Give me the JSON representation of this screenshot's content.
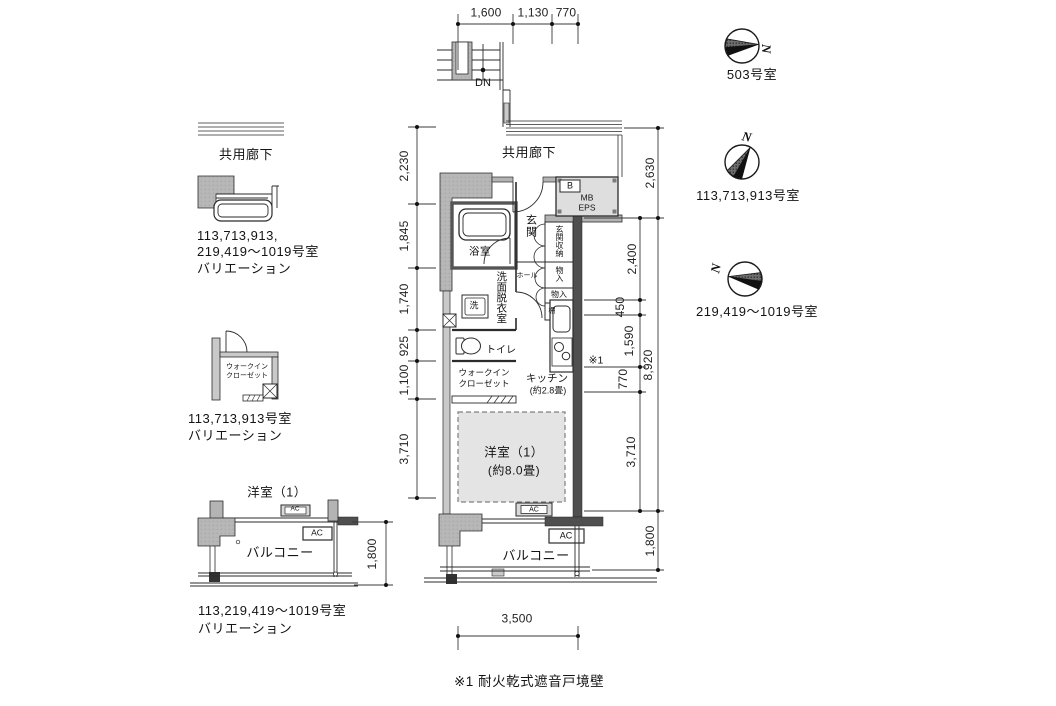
{
  "note": "※1 耐火乾式遮音戸境壁",
  "dims": {
    "top": [
      "1,600",
      "1,130",
      "770"
    ],
    "left": [
      "2,230",
      "1,845",
      "1,740",
      "925",
      "1,100",
      "3,710"
    ],
    "right_inner": [
      "2,400",
      "450",
      "1,590",
      "770",
      "3,710"
    ],
    "right_outer": [
      "2,630",
      "8,920",
      "1,800"
    ],
    "bottom": "3,500"
  },
  "plan": {
    "corridor": "共用廊下",
    "down": "DN",
    "b_box": "B",
    "mb": "MB",
    "eps": "EPS",
    "bath": "浴室",
    "entrance": "玄関",
    "entrance_storage": "玄関収納",
    "storage_a": "物入",
    "storage_b": "物入",
    "shelf": "棚",
    "hall": "ホール",
    "washroom": "洗面脱衣室",
    "washer": "洗",
    "toilet": "トイレ",
    "wic1": "ウォークイン",
    "wic2": "クローゼット",
    "kitchen1": "キッチン",
    "kitchen2": "(約2.8畳)",
    "room1": "洋室（1）",
    "room2": "(約8.0畳)",
    "ac_window": "AC",
    "ac_balcony": "AC",
    "balcony": "バルコニー",
    "ref1": "※1"
  },
  "variations": {
    "top": {
      "corridor": "共用廊下",
      "caption1": "113,713,913,",
      "caption2": "219,419～1019号室",
      "caption3": "バリエーション"
    },
    "middle": {
      "wic1": "ウォークイン",
      "wic2": "クローゼット",
      "caption1": "113,713,913号室",
      "caption2": "バリエーション"
    },
    "bottom": {
      "room": "洋室（1）",
      "ac1": "AC",
      "ac2": "AC",
      "balcony": "バルコニー",
      "dim": "1,800",
      "caption1": "113,219,419～1019号室",
      "caption2": "バリエーション"
    }
  },
  "compasses": [
    {
      "north": "N",
      "label": "503号室"
    },
    {
      "north": "N",
      "label": "113,713,913号室"
    },
    {
      "north": "N",
      "label": "219,419～1019号室"
    }
  ]
}
